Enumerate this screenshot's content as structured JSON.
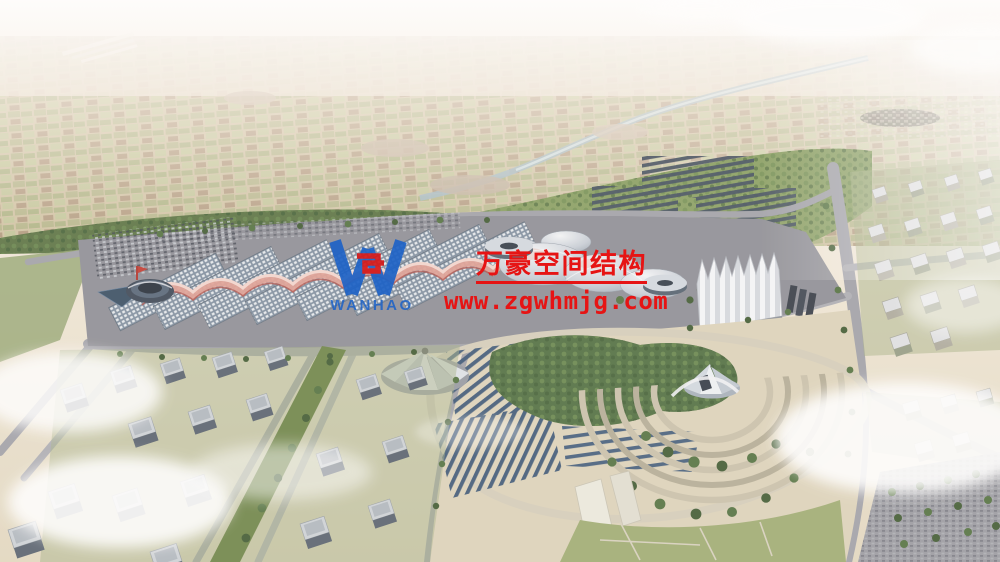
{
  "watermark": {
    "logo_icon": "wanhao-w-logo",
    "logo_text": "WANHAO",
    "company_name": "万豪空间结构",
    "website": "www.zgwhmjg.com",
    "accent_red": "#e61414",
    "accent_blue": "#1f63c6"
  }
}
